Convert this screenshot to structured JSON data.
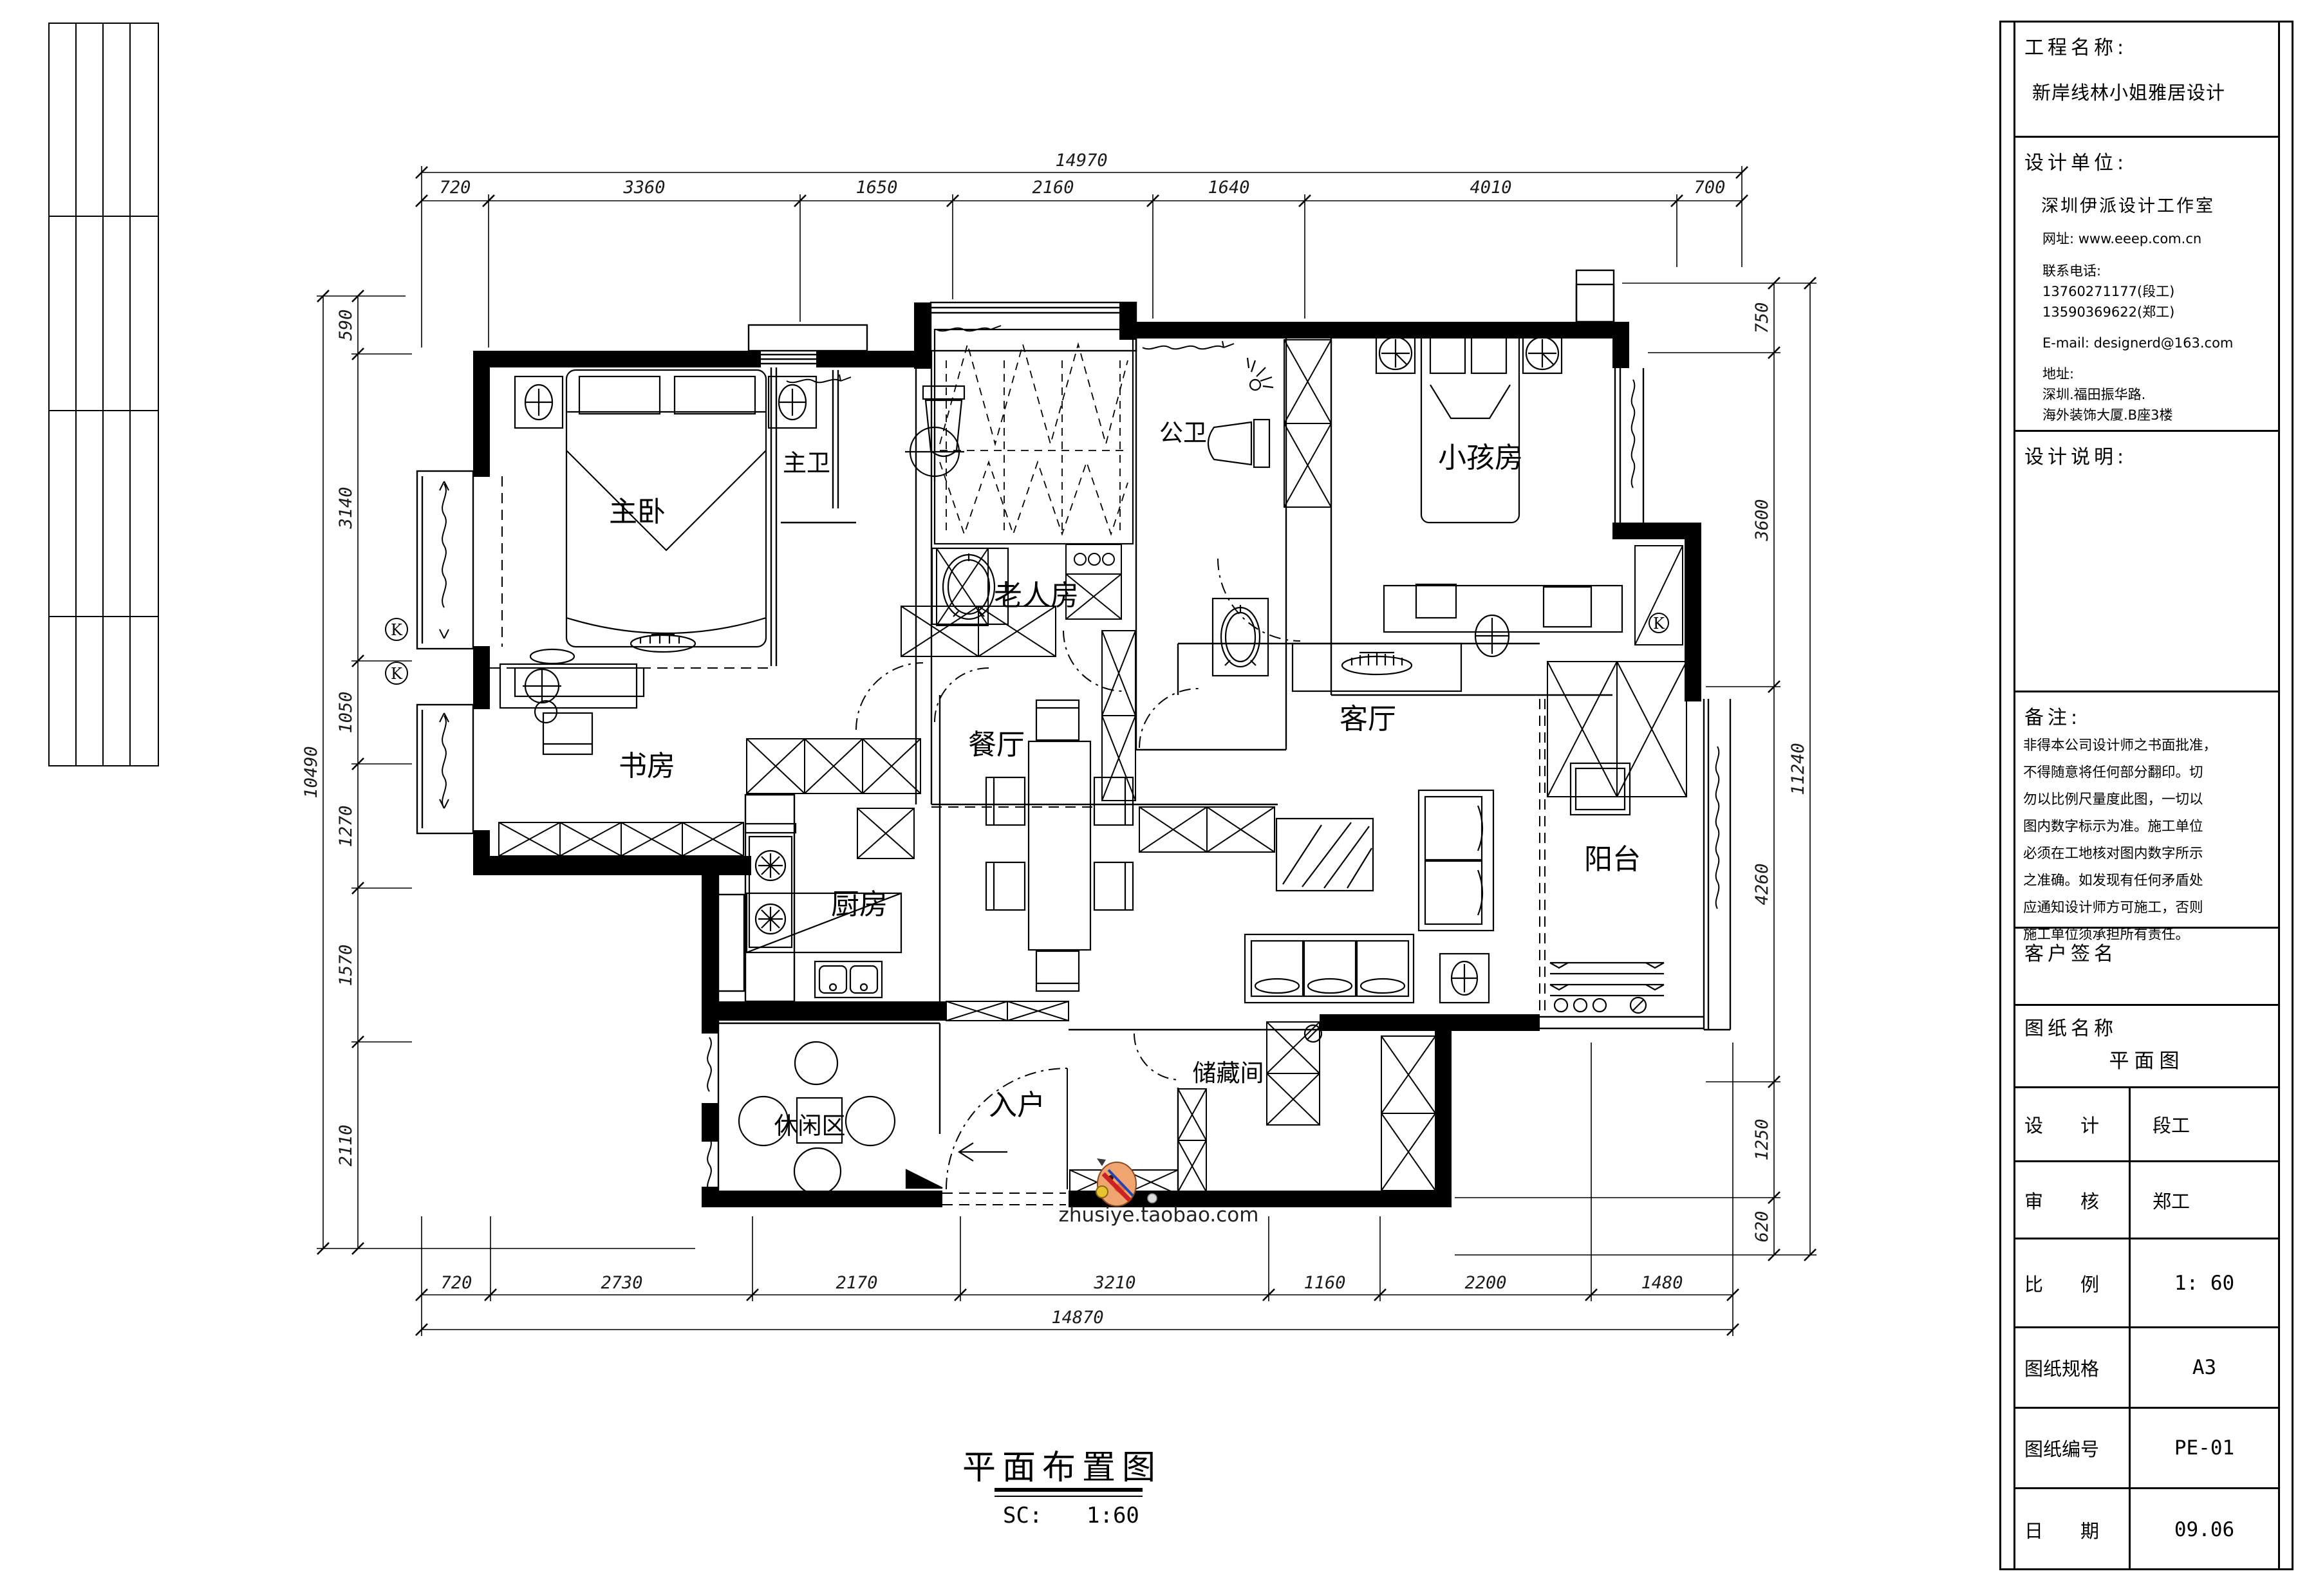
{
  "sheet": {
    "plan_title": "平面布置图",
    "scale_label": "SC:",
    "scale_value": "1:60",
    "watermark_text": "zhusiye.taobao.com"
  },
  "rooms": {
    "master_bedroom": "主卧",
    "master_bath": "主卫",
    "elder_room": "老人房",
    "public_bath": "公卫",
    "kids_room": "小孩房",
    "study": "书房",
    "dining": "餐厅",
    "kitchen": "厨房",
    "living": "客厅",
    "balcony": "阳台",
    "leisure": "休闲区",
    "entry": "入户",
    "storage": "储藏间"
  },
  "annotations": {
    "k_mark": "K"
  },
  "dimensions": {
    "top": {
      "total": "14970",
      "segments": [
        "720",
        "3360",
        "1650",
        "2160",
        "1640",
        "4010",
        "700"
      ]
    },
    "bottom": {
      "total": "14870",
      "segments": [
        "720",
        "2730",
        "2170",
        "3210",
        "1160",
        "2200",
        "1480"
      ]
    },
    "left": {
      "total": "10490",
      "segments": [
        "590",
        "3140",
        "1050",
        "1270",
        "1570",
        "2110"
      ]
    },
    "right": {
      "total": "11240",
      "segments": [
        "750",
        "3600",
        "4260",
        "1250",
        "620"
      ]
    }
  },
  "title_block": {
    "project_label": "工程名称:",
    "project_name": "新岸线林小姐雅居设计",
    "design_unit_label": "设计单位:",
    "design_unit_name": "深圳伊派设计工作室",
    "website": "网址: www.eeep.com.cn",
    "phone_label": "联系电话:",
    "phone_1": "13760271177(段工)",
    "phone_2": "13590369622(郑工)",
    "email": "E-mail:  designerd@163.com",
    "address_label": "地址:",
    "address_line1": "深圳.福田振华路.",
    "address_line2": "海外装饰大厦.B座3楼",
    "design_notes_label": "设计说明:",
    "remark_label": "备注:",
    "remark_lines": [
      "非得本公司设计师之书面批准，",
      "不得随意将任何部分翻印。切",
      "勿以比例尺量度此图，一切以",
      "图内数字标示为准。施工单位",
      "必须在工地核对图内数字所示",
      "之准确。如发现有任何矛盾处",
      "应通知设计师方可施工，否则",
      "施工单位须承担所有责任。"
    ],
    "client_sign_label": "客户签名",
    "sheet_name_label": "图纸名称",
    "sheet_name_value": "平面图",
    "table_rows": [
      {
        "label": "设　　计",
        "value": "段工"
      },
      {
        "label": "审　　核",
        "value": "郑工"
      },
      {
        "label": "比　　例",
        "value": "1: 60"
      },
      {
        "label": "图纸规格",
        "value": "A3"
      },
      {
        "label": "图纸编号",
        "value": "PE-01"
      },
      {
        "label": "日　　期",
        "value": "09.06"
      }
    ]
  }
}
